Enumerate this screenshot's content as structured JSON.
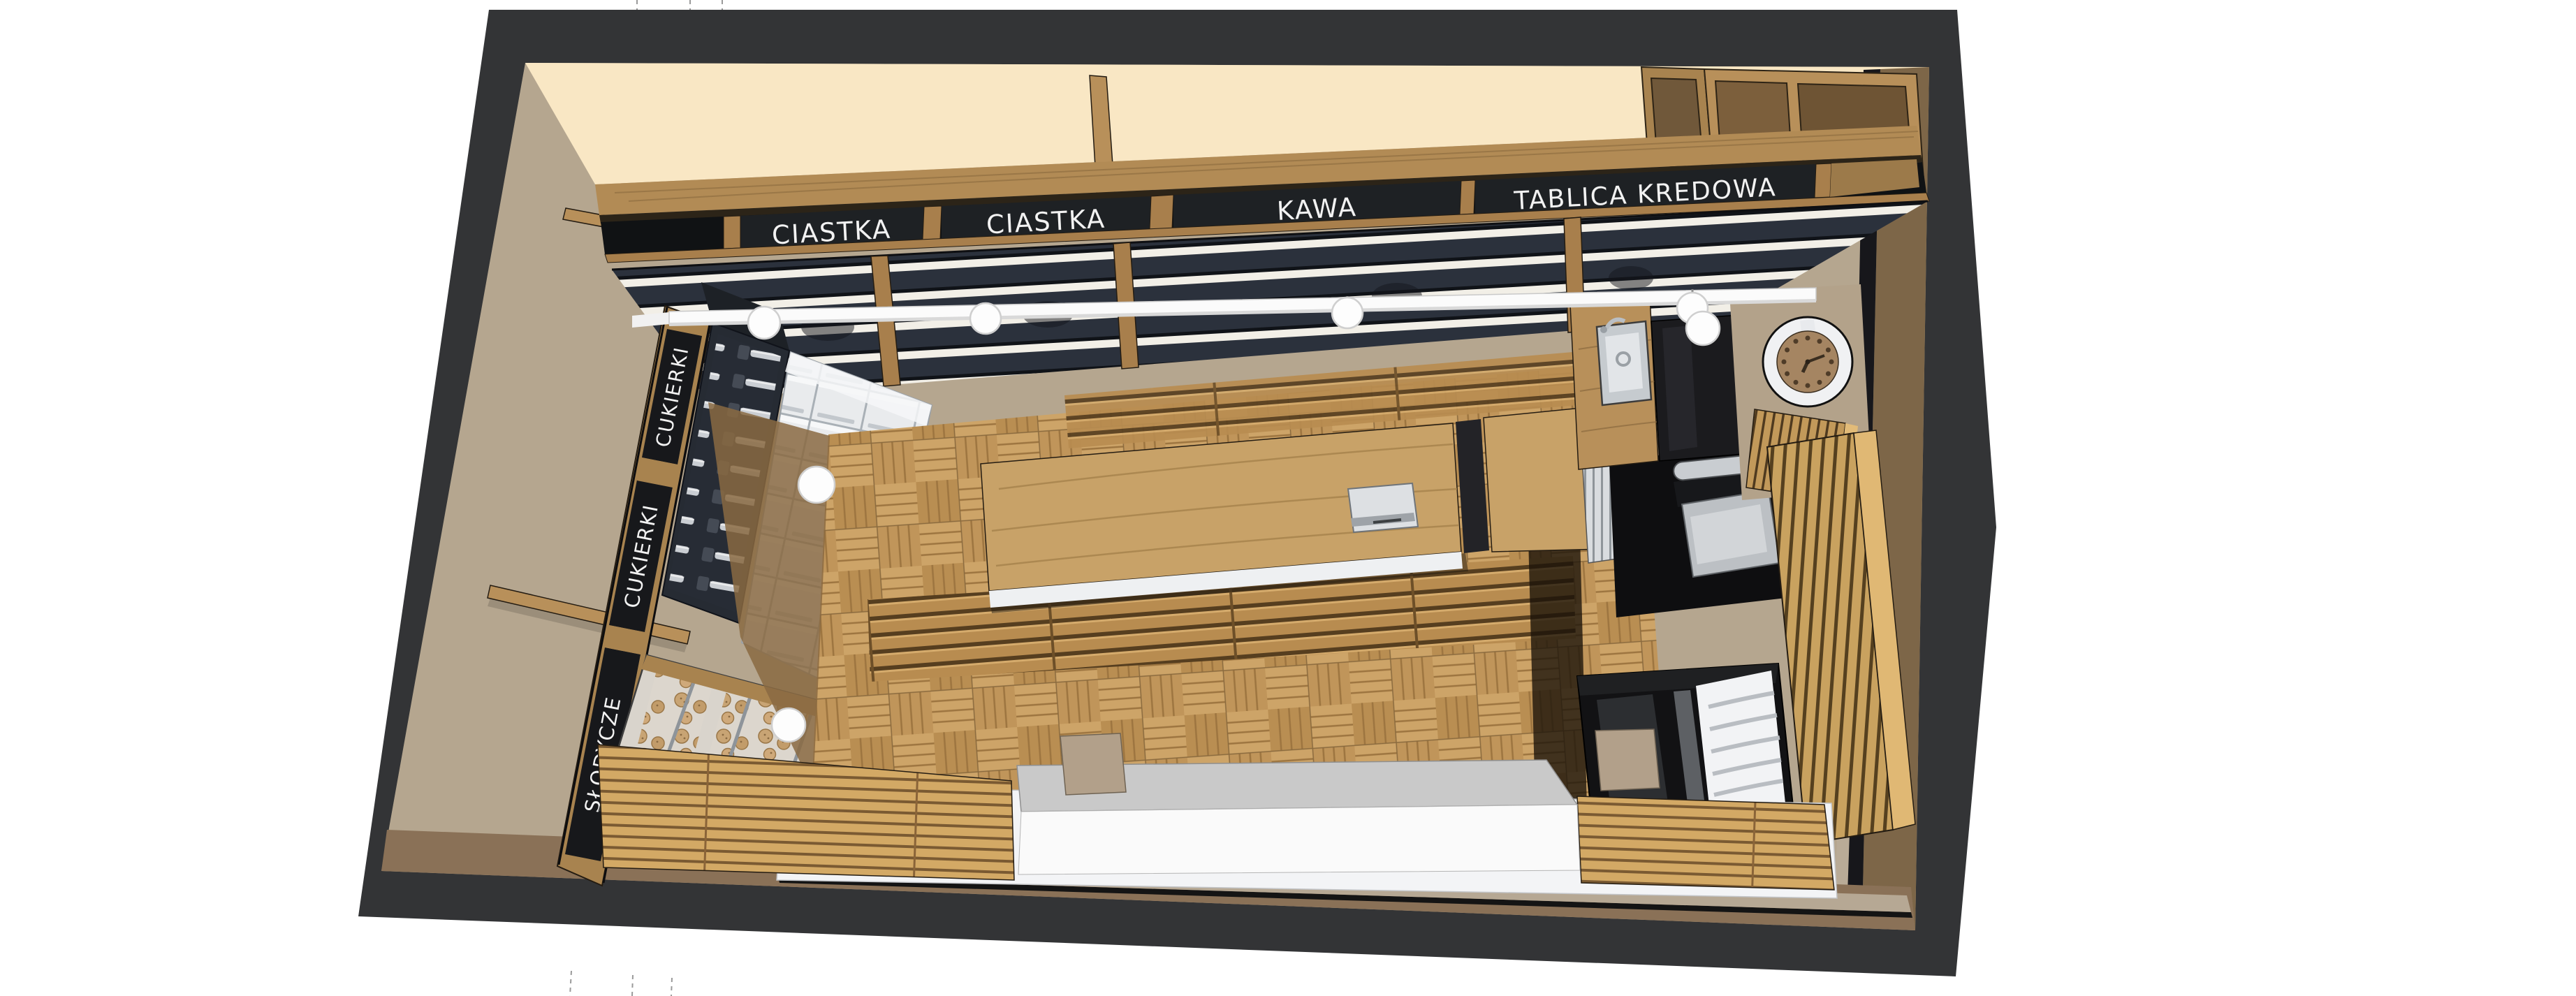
{
  "scene": {
    "type": "3d-interior-render",
    "view": "top-down axonometric",
    "subject": "sweet shop and coffee bar interior model"
  },
  "palette": {
    "background": "#ffffff",
    "frame_charcoal": "#333436",
    "exterior_brown": "#7d6648",
    "wall_tan": "#b5a68f",
    "ceiling_cream": "#f9e7c4",
    "wood": "#b28b55",
    "wood_light": "#c8a268",
    "wood_pale": "#e0b874",
    "sign_board": "#1e2124",
    "sign_text": "#f2f2f2",
    "baffle_slat": "#2b313c",
    "floor_parquet": "#c69d61",
    "metal": "#d7dadd",
    "gloss_black": "#121214"
  },
  "ceiling_signs": [
    {
      "label": "CIASTKA"
    },
    {
      "label": "CIASTKA"
    },
    {
      "label": "KAWA"
    },
    {
      "label": "TABLICA KREDOWA"
    }
  ],
  "wall_signs": [
    {
      "label": "CUKIERKI"
    },
    {
      "label": "CUKIERKI"
    },
    {
      "label": "SŁODYCZE"
    }
  ],
  "fixtures": {
    "clock": "wall clock",
    "sink": "counter sink",
    "espresso_machine": "espresso machine",
    "pastry_case": "pastry display fridge",
    "pos_terminal": "counter terminal",
    "pendant_lights": "globe pendant lights",
    "track_light": "linear tube light",
    "candy_dispensers": "candy dispenser wall",
    "bin_shelves": "metal bin shelving",
    "cookie_case": "cookie display case",
    "slat_partition": "wood slat partition",
    "storefront_bench": "storefront bench and sill"
  }
}
